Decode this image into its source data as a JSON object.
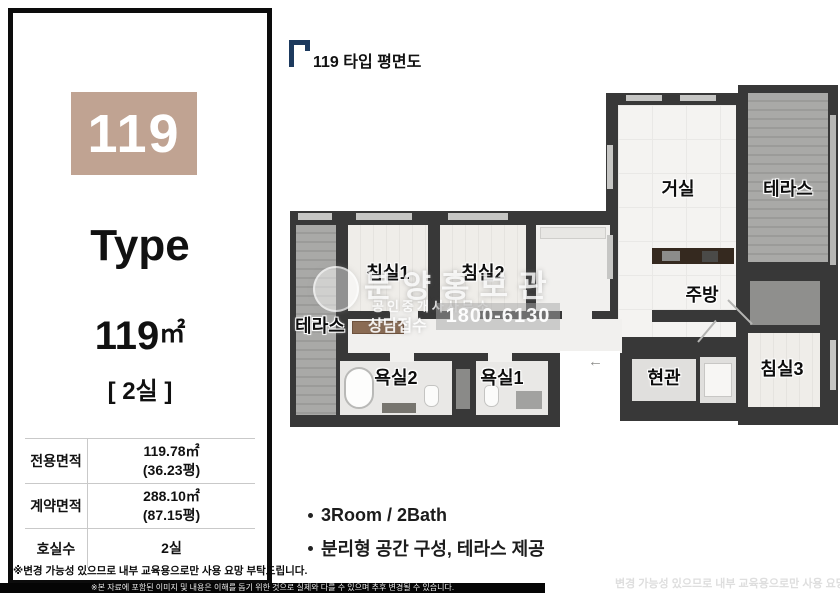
{
  "colors": {
    "accent_tan": "#c0a392",
    "wall_dark": "#383838",
    "header_navy": "#1d3a5e"
  },
  "left_panel": {
    "unit_number": "119",
    "type_label": "Type",
    "area_value": "119",
    "area_unit": "㎡",
    "rooms_label": "[ 2실 ]",
    "table": {
      "rows": [
        {
          "label": "전용면적",
          "line1": "119.78㎡",
          "line2": "(36.23평)"
        },
        {
          "label": "계약면적",
          "line1": "288.10㎡",
          "line2": "(87.15평)"
        },
        {
          "label": "호실수",
          "line1": "2실",
          "line2": ""
        }
      ]
    },
    "notice": "※변경 가능성 있으므로 내부 교육용으로만 사용 요망 부탁드립니다."
  },
  "plan_header": {
    "title": "119 타입 평면도"
  },
  "floor_plan": {
    "rooms": [
      {
        "id": "living",
        "label": "거실"
      },
      {
        "id": "terrace-top",
        "label": "테라스"
      },
      {
        "id": "kitchen",
        "label": "주방"
      },
      {
        "id": "bedroom1",
        "label": "침실1"
      },
      {
        "id": "bedroom2",
        "label": "침실2"
      },
      {
        "id": "bedroom3",
        "label": "침실3"
      },
      {
        "id": "bathroom1",
        "label": "욕실1"
      },
      {
        "id": "bathroom2",
        "label": "욕실2"
      },
      {
        "id": "entrance",
        "label": "현관"
      },
      {
        "id": "terrace-left",
        "label": "테라스"
      }
    ],
    "entry_arrow": "←"
  },
  "watermark": {
    "title": "분양홍보관",
    "subtitle": "공인중개사사무소",
    "contact_label": "상담접수",
    "phone": "1800-6130"
  },
  "features": {
    "items": [
      {
        "text": "3Room / 2Bath"
      },
      {
        "text": "분리형 공간 구성, 테라스 제공"
      }
    ]
  },
  "footer": {
    "bottom_bar": "※본 자료에 포함된 이미지 및 내용은 이해를 돕기 위한 것으로 실제와 다를 수 있으며 추후 변경될 수 있습니다.",
    "right_note": "변경 가능성 있으므로 내부 교육용으로만 사용 요망 부탁드립니다"
  }
}
